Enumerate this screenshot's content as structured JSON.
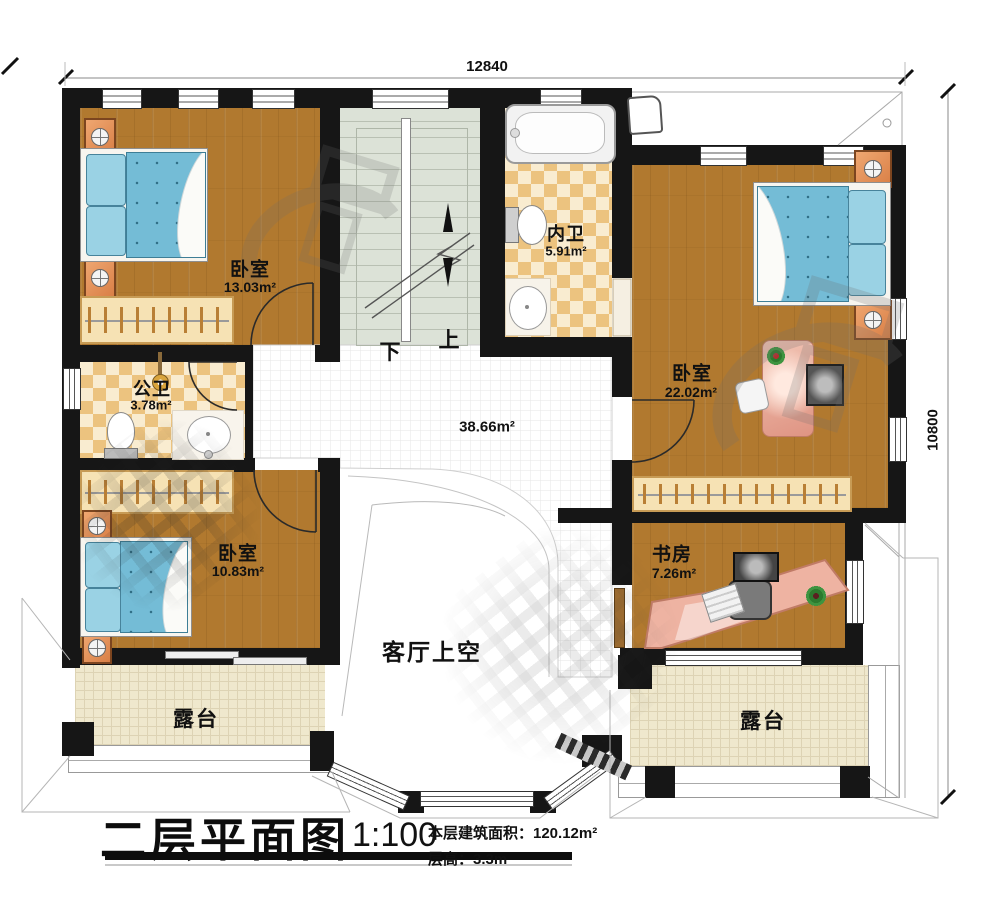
{
  "title": {
    "main": "二层平面图",
    "scale": "1:100",
    "area_line": "本层建筑面积：120.12m²",
    "floor_height_line": "层高：3.3m"
  },
  "dims": {
    "top": "12840",
    "right": "10800"
  },
  "rooms": {
    "bedroom_tl": {
      "name": "卧室",
      "area": "13.03m²"
    },
    "ensuite": {
      "name": "内卫",
      "area": "5.91m²"
    },
    "bedroom_tr": {
      "name": "卧室",
      "area": "22.02m²"
    },
    "public_bath": {
      "name": "公卫",
      "area": "3.78m²"
    },
    "bedroom_bl": {
      "name": "卧室",
      "area": "10.83m²"
    },
    "study": {
      "name": "书房",
      "area": "7.26m²"
    },
    "hall": {
      "area": "38.66m²"
    },
    "void": {
      "label": "客厅上空"
    },
    "terrace_left": {
      "label": "露台"
    },
    "terrace_right": {
      "label": "露台"
    }
  },
  "stairs": {
    "down": "下",
    "up": "上"
  }
}
